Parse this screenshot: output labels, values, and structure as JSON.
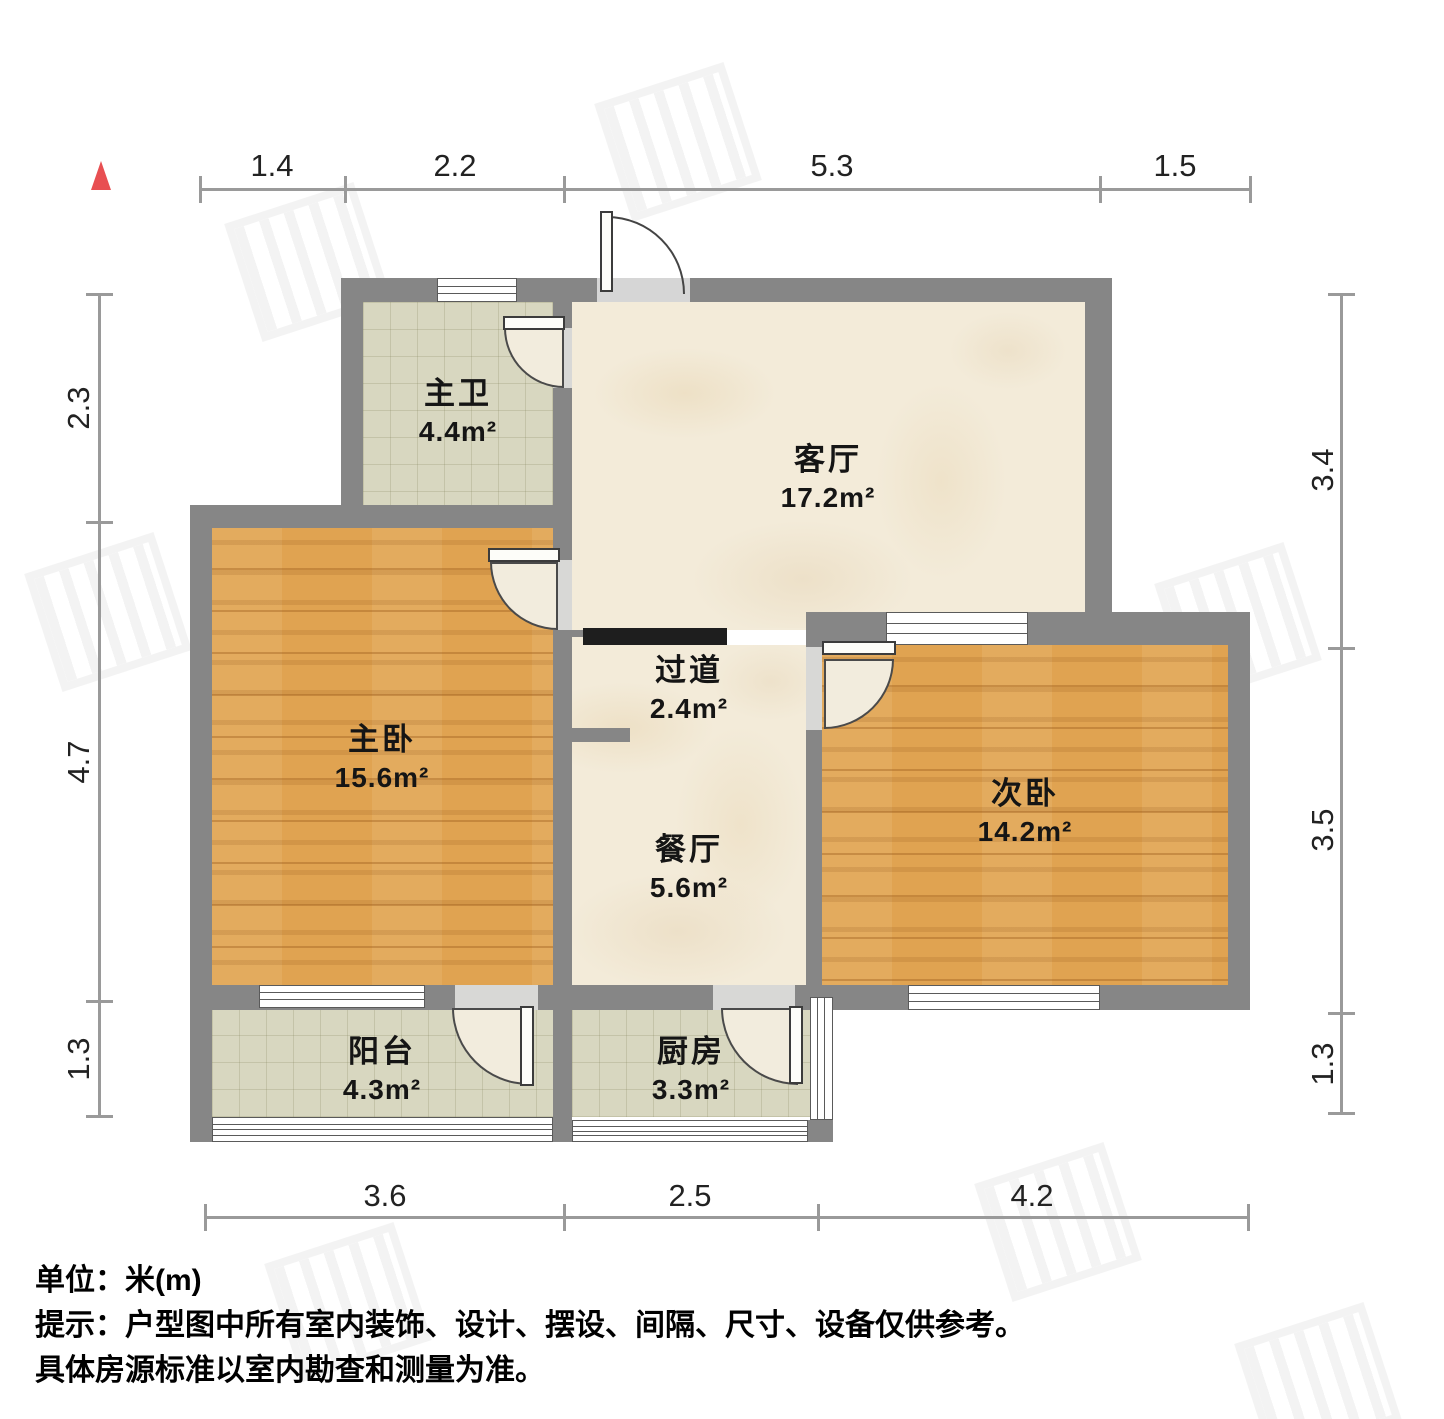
{
  "rooms": [
    {
      "id": "master-bath",
      "name": "主卫",
      "area": "4.4m²"
    },
    {
      "id": "living-room",
      "name": "客厅",
      "area": "17.2m²"
    },
    {
      "id": "master-bedroom",
      "name": "主卧",
      "area": "15.6m²"
    },
    {
      "id": "corridor",
      "name": "过道",
      "area": "2.4m²"
    },
    {
      "id": "dining-room",
      "name": "餐厅",
      "area": "5.6m²"
    },
    {
      "id": "second-bedroom",
      "name": "次卧",
      "area": "14.2m²"
    },
    {
      "id": "balcony",
      "name": "阳台",
      "area": "4.3m²"
    },
    {
      "id": "kitchen",
      "name": "厨房",
      "area": "3.3m²"
    }
  ],
  "dimensions": {
    "top": [
      "1.4",
      "2.2",
      "5.3",
      "1.5"
    ],
    "bottom": [
      "3.6",
      "2.5",
      "4.2"
    ],
    "left": [
      "2.3",
      "4.7",
      "1.3"
    ],
    "right": [
      "3.4",
      "3.5",
      "1.3"
    ]
  },
  "notes": {
    "unit": "单位：米(m)",
    "tip": "提示：户型图中所有室内装饰、设计、摆设、间隔、尺寸、设备仅供参考。",
    "tip2": "具体房源标准以室内勘查和测量为准。"
  },
  "colors": {
    "wall": "#868686",
    "wall_dark": "#1e1e1e",
    "wood_floor": "#e0a351",
    "tile_floor": "#d8d7c0",
    "marble_floor": "#f3ebd9",
    "north_arrow": "#e84f52",
    "dimension_text": "#222222"
  }
}
